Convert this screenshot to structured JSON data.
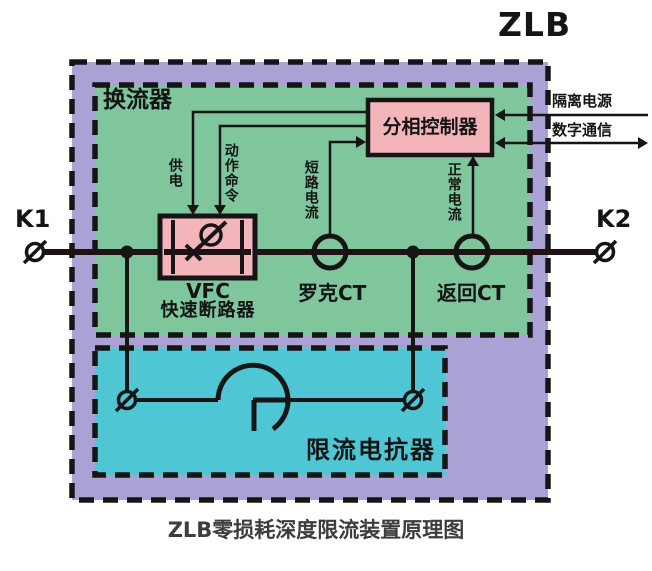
{
  "title": "ZLB",
  "caption": "ZLB零损耗深度限流装置原理图",
  "terminals": {
    "left": "K1",
    "right": "K2"
  },
  "zones": {
    "converter": {
      "label": "换流器"
    },
    "reactor": {
      "label": "限流电抗器"
    }
  },
  "components": {
    "controller": {
      "label": "分相控制器"
    },
    "breaker": {
      "label_line1": "VFC",
      "label_line2": "快速断路器"
    },
    "rogowski_ct": {
      "label": "罗克CT"
    },
    "return_ct": {
      "label": "返回CT"
    }
  },
  "signals": {
    "power_supply": "供电",
    "action_command": "动作命令",
    "short_circuit_current": "短路电流",
    "normal_current": "正常电流",
    "isolated_power": "隔离电源",
    "digital_comm": "数字通信"
  },
  "colors": {
    "outer_fill": "#aaa2d4",
    "converter_fill": "#7fc69c",
    "reactor_fill": "#4fc6d3",
    "component_fill": "#f3b5b9",
    "bus_line": "#1e1215"
  }
}
